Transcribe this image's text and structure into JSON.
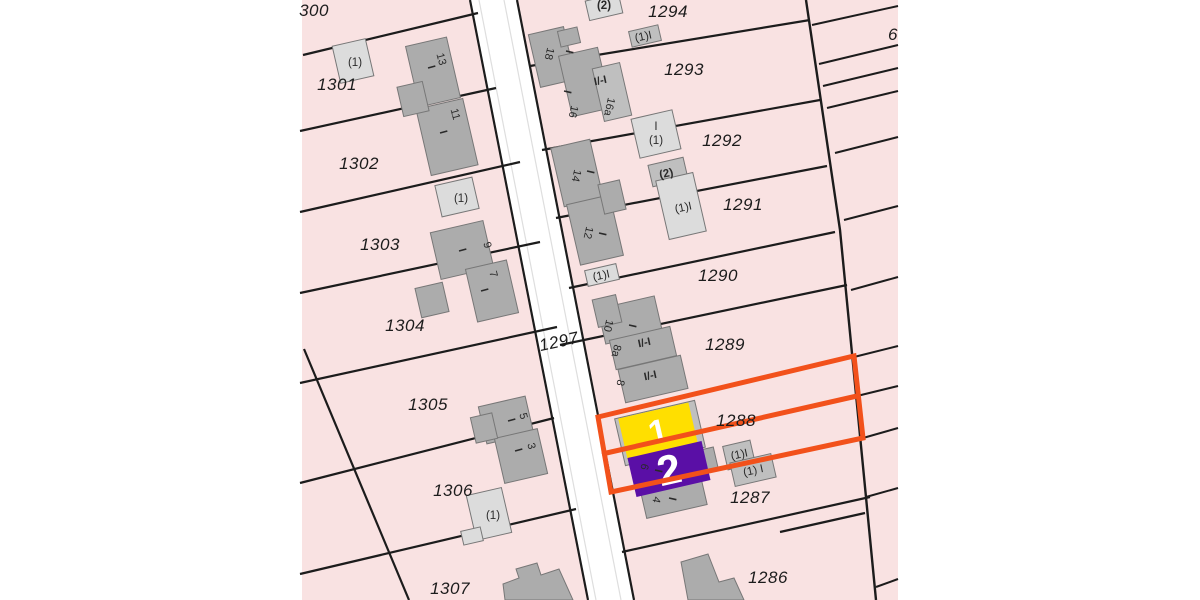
{
  "scene": {
    "type": "cadastral-parcel-map",
    "width": 1200,
    "height": 600
  },
  "colors": {
    "canvas_bg": "#ffffff",
    "parcel_fill": "#F9E2E2",
    "boundary_line": "#1c1c1c",
    "road_fill": "#ffffff",
    "road_inner_line": "#dedede",
    "building_dark": "#ACACAC",
    "building_mid": "#BFBFBF",
    "building_light": "#DCDCDC",
    "building_stroke": "#777777",
    "highlight_orange": "#F2511B",
    "selection_yellow": "#FFDF00",
    "selection_purple": "#5A0FA6",
    "label_color": "#1c1c1c",
    "small_label_color": "#2a2a2a",
    "selection_label_color": "#ffffff"
  },
  "map_area": {
    "x": 302,
    "y": 0,
    "w": 596,
    "h": 600
  },
  "road": {
    "polygon": "470,0 517,0 634,600 588,600",
    "left_edge": [
      470,
      0,
      588,
      600
    ],
    "right_edge": [
      517,
      0,
      634,
      600
    ],
    "inner_lines": [
      [
        479,
        0,
        596,
        600
      ],
      [
        504,
        0,
        621,
        600
      ]
    ]
  },
  "boundaries": [
    [
      303,
      55,
      478,
      13
    ],
    [
      300,
      131,
      496,
      88
    ],
    [
      300,
      212,
      520,
      162
    ],
    [
      300,
      293,
      540,
      242
    ],
    [
      300,
      383,
      557,
      327
    ],
    [
      300,
      483,
      554,
      418
    ],
    [
      300,
      574,
      576,
      509
    ],
    [
      304,
      349,
      409,
      600
    ],
    [
      530,
      66,
      810,
      20
    ],
    [
      542,
      150,
      820,
      100
    ],
    [
      556,
      218,
      827,
      166
    ],
    [
      569,
      288,
      835,
      232
    ],
    [
      560,
      345,
      847,
      285
    ],
    [
      597,
      417,
      854,
      356
    ],
    [
      602,
      454,
      857,
      396
    ],
    [
      611,
      492,
      863,
      438
    ],
    [
      622,
      552,
      870,
      497
    ],
    [
      780,
      532,
      865,
      513
    ]
  ],
  "spine": "806,0 840,230 876,600",
  "strip_lines": [
    [
      812,
      25,
      898,
      6
    ],
    [
      819,
      64,
      898,
      45
    ],
    [
      823,
      86,
      898,
      68
    ],
    [
      827,
      108,
      898,
      91
    ],
    [
      835,
      153,
      898,
      137
    ],
    [
      844,
      220,
      898,
      206
    ],
    [
      851,
      290,
      898,
      277
    ],
    [
      854,
      357,
      898,
      346
    ],
    [
      857,
      396,
      898,
      386
    ],
    [
      863,
      438,
      898,
      428
    ],
    [
      866,
      497,
      898,
      488
    ],
    [
      876,
      587,
      898,
      579
    ]
  ],
  "buildings": {
    "rects": [
      {
        "cx": 433,
        "cy": 72,
        "w": 42,
        "h": 62,
        "rot": -13,
        "fill": "dark"
      },
      {
        "cx": 447,
        "cy": 137,
        "w": 48,
        "h": 68,
        "rot": -13,
        "fill": "dark"
      },
      {
        "cx": 413,
        "cy": 99,
        "w": 26,
        "h": 30,
        "rot": -13,
        "fill": "dark"
      },
      {
        "cx": 353,
        "cy": 61,
        "w": 34,
        "h": 38,
        "rot": -13,
        "fill": "light"
      },
      {
        "cx": 462,
        "cy": 250,
        "w": 54,
        "h": 48,
        "rot": -13,
        "fill": "dark"
      },
      {
        "cx": 492,
        "cy": 291,
        "w": 42,
        "h": 54,
        "rot": -13,
        "fill": "dark"
      },
      {
        "cx": 432,
        "cy": 300,
        "w": 28,
        "h": 30,
        "rot": -13,
        "fill": "dark"
      },
      {
        "cx": 457,
        "cy": 197,
        "w": 38,
        "h": 32,
        "rot": -13,
        "fill": "light"
      },
      {
        "cx": 506,
        "cy": 420,
        "w": 48,
        "h": 38,
        "rot": -13,
        "fill": "dark"
      },
      {
        "cx": 521,
        "cy": 456,
        "w": 44,
        "h": 46,
        "rot": -13,
        "fill": "dark"
      },
      {
        "cx": 484,
        "cy": 428,
        "w": 22,
        "h": 26,
        "rot": -13,
        "fill": "dark"
      },
      {
        "cx": 489,
        "cy": 514,
        "w": 36,
        "h": 46,
        "rot": -13,
        "fill": "light"
      },
      {
        "cx": 472,
        "cy": 536,
        "w": 20,
        "h": 14,
        "rot": -13,
        "fill": "light"
      },
      {
        "cx": 552,
        "cy": 57,
        "w": 36,
        "h": 54,
        "rot": -13,
        "fill": "dark"
      },
      {
        "cx": 585,
        "cy": 82,
        "w": 40,
        "h": 62,
        "rot": -13,
        "fill": "dark"
      },
      {
        "cx": 612,
        "cy": 92,
        "w": 28,
        "h": 54,
        "rot": -13,
        "fill": "mid"
      },
      {
        "cx": 569,
        "cy": 37,
        "w": 20,
        "h": 16,
        "rot": -13,
        "fill": "dark"
      },
      {
        "cx": 645,
        "cy": 36,
        "w": 30,
        "h": 16,
        "rot": -13,
        "fill": "mid"
      },
      {
        "cx": 604,
        "cy": 7,
        "w": 34,
        "h": 20,
        "rot": -13,
        "fill": "light"
      },
      {
        "cx": 577,
        "cy": 173,
        "w": 40,
        "h": 60,
        "rot": -13,
        "fill": "dark"
      },
      {
        "cx": 595,
        "cy": 230,
        "w": 44,
        "h": 62,
        "rot": -13,
        "fill": "dark"
      },
      {
        "cx": 612,
        "cy": 197,
        "w": 22,
        "h": 30,
        "rot": -13,
        "fill": "dark"
      },
      {
        "cx": 668,
        "cy": 172,
        "w": 36,
        "h": 22,
        "rot": -13,
        "fill": "mid"
      },
      {
        "cx": 681,
        "cy": 206,
        "w": 38,
        "h": 60,
        "rot": -13,
        "fill": "light"
      },
      {
        "cx": 656,
        "cy": 134,
        "w": 42,
        "h": 40,
        "rot": -13,
        "fill": "light"
      },
      {
        "cx": 602,
        "cy": 275,
        "w": 32,
        "h": 16,
        "rot": -13,
        "fill": "light"
      },
      {
        "cx": 630,
        "cy": 320,
        "w": 58,
        "h": 36,
        "rot": -13,
        "fill": "dark"
      },
      {
        "cx": 643,
        "cy": 348,
        "w": 62,
        "h": 30,
        "rot": -13,
        "fill": "dark"
      },
      {
        "cx": 653,
        "cy": 379,
        "w": 64,
        "h": 34,
        "rot": -13,
        "fill": "dark"
      },
      {
        "cx": 607,
        "cy": 311,
        "w": 24,
        "h": 28,
        "rot": -13,
        "fill": "dark"
      },
      {
        "cx": 660,
        "cy": 433,
        "w": 82,
        "h": 48,
        "rot": -13,
        "fill": "mid"
      },
      {
        "cx": 672,
        "cy": 490,
        "w": 62,
        "h": 44,
        "rot": -13,
        "fill": "dark"
      },
      {
        "cx": 706,
        "cy": 460,
        "w": 20,
        "h": 22,
        "rot": -13,
        "fill": "dark"
      },
      {
        "cx": 739,
        "cy": 455,
        "w": 28,
        "h": 24,
        "rot": -13,
        "fill": "mid"
      },
      {
        "cx": 753,
        "cy": 470,
        "w": 42,
        "h": 24,
        "rot": -13,
        "fill": "mid"
      }
    ],
    "polys": [
      {
        "points": "503,584 519,578 516,569 537,563 541,575 559,569 573,600 505,600",
        "fill": "dark"
      },
      {
        "points": "681,562 708,554 719,582 734,578 744,600 688,600",
        "fill": "dark"
      }
    ]
  },
  "highlight": {
    "outline": "598,417 854,356 863,438 611,492",
    "divider": [
      602,
      454,
      857,
      396
    ],
    "stroke_width": 5
  },
  "selection": [
    {
      "label": "1",
      "cx": 658,
      "cy": 431,
      "w": 72,
      "h": 42,
      "rot": -13,
      "color": "#FFDF00",
      "font": 34
    },
    {
      "label": "2",
      "cx": 669,
      "cy": 469,
      "w": 76,
      "h": 40,
      "rot": -13,
      "color": "#5A0FA6",
      "font": 42
    }
  ],
  "labels": {
    "parcels": [
      {
        "text": "300",
        "x": 314,
        "y": 16
      },
      {
        "text": "1301",
        "x": 337,
        "y": 90
      },
      {
        "text": "1302",
        "x": 359,
        "y": 169
      },
      {
        "text": "1303",
        "x": 380,
        "y": 250
      },
      {
        "text": "1304",
        "x": 405,
        "y": 331
      },
      {
        "text": "1305",
        "x": 428,
        "y": 410
      },
      {
        "text": "1306",
        "x": 453,
        "y": 496
      },
      {
        "text": "1307",
        "x": 450,
        "y": 594
      },
      {
        "text": "1297",
        "x": 560,
        "y": 347,
        "rot": -12
      },
      {
        "text": "1294",
        "x": 668,
        "y": 17
      },
      {
        "text": "1293",
        "x": 684,
        "y": 75
      },
      {
        "text": "1292",
        "x": 722,
        "y": 146
      },
      {
        "text": "1291",
        "x": 743,
        "y": 210
      },
      {
        "text": "1290",
        "x": 718,
        "y": 281
      },
      {
        "text": "1289",
        "x": 725,
        "y": 350
      },
      {
        "text": "1288",
        "x": 736,
        "y": 426
      },
      {
        "text": "1287",
        "x": 750,
        "y": 503
      },
      {
        "text": "1286",
        "x": 768,
        "y": 583
      },
      {
        "text": "6",
        "x": 893,
        "y": 40
      }
    ],
    "house_numbers": [
      {
        "text": "13",
        "x": 438,
        "y": 60,
        "rot": 75
      },
      {
        "text": "11",
        "x": 452,
        "y": 115,
        "rot": 75
      },
      {
        "text": "9",
        "x": 484,
        "y": 246,
        "rot": 75
      },
      {
        "text": "7",
        "x": 490,
        "y": 275,
        "rot": 75
      },
      {
        "text": "5",
        "x": 520,
        "y": 417,
        "rot": 75
      },
      {
        "text": "3",
        "x": 528,
        "y": 447,
        "rot": 75
      },
      {
        "text": "18",
        "x": 546,
        "y": 53,
        "rot": 103
      },
      {
        "text": "16",
        "x": 570,
        "y": 111,
        "rot": 103
      },
      {
        "text": "16a",
        "x": 606,
        "y": 106,
        "rot": 103
      },
      {
        "text": "14",
        "x": 573,
        "y": 175,
        "rot": 103
      },
      {
        "text": "12",
        "x": 585,
        "y": 232,
        "rot": 103
      },
      {
        "text": "10",
        "x": 605,
        "y": 325,
        "rot": 103
      },
      {
        "text": "8a",
        "x": 613,
        "y": 350,
        "rot": 103
      },
      {
        "text": "8",
        "x": 617,
        "y": 382,
        "rot": 103
      },
      {
        "text": "6",
        "x": 641,
        "y": 466,
        "rot": 103
      },
      {
        "text": "4",
        "x": 653,
        "y": 499,
        "rot": 103
      }
    ],
    "storeys": [
      {
        "text": "I",
        "x": 428,
        "y": 68,
        "rot": 75
      },
      {
        "text": "I",
        "x": 440,
        "y": 133,
        "rot": 75
      },
      {
        "text": "I",
        "x": 459,
        "y": 251,
        "rot": 75
      },
      {
        "text": "I",
        "x": 481,
        "y": 291,
        "rot": 75
      },
      {
        "text": "I",
        "x": 508,
        "y": 421,
        "rot": 75
      },
      {
        "text": "I",
        "x": 515,
        "y": 451,
        "rot": 75
      },
      {
        "text": "I",
        "x": 566,
        "y": 51,
        "rot": 103
      },
      {
        "text": "I",
        "x": 564,
        "y": 91,
        "rot": 103
      },
      {
        "text": "I",
        "x": 587,
        "y": 171,
        "rot": 103
      },
      {
        "text": "I",
        "x": 599,
        "y": 233,
        "rot": 103
      },
      {
        "text": "I",
        "x": 629,
        "y": 325,
        "rot": 103
      },
      {
        "text": "I",
        "x": 655,
        "y": 470,
        "rot": 103
      },
      {
        "text": "I",
        "x": 669,
        "y": 498,
        "rot": 103
      },
      {
        "text": "I/-I",
        "x": 601,
        "y": 84,
        "rot": -12
      },
      {
        "text": "I/-I",
        "x": 645,
        "y": 346,
        "rot": -12
      },
      {
        "text": "I/-I",
        "x": 651,
        "y": 379,
        "rot": -12
      }
    ],
    "annex": [
      {
        "text": "(1)",
        "x": 355,
        "y": 66,
        "bold": false
      },
      {
        "text": "(1)",
        "x": 461,
        "y": 202,
        "bold": false
      },
      {
        "text": "(1)",
        "x": 493,
        "y": 519,
        "bold": false
      },
      {
        "text": "I",
        "x": 656,
        "y": 130,
        "bold": false
      },
      {
        "text": "(1)",
        "x": 656,
        "y": 144,
        "bold": false
      },
      {
        "text": "(1)I",
        "x": 684,
        "y": 211,
        "rot": -12,
        "bold": false
      },
      {
        "text": "(1)I",
        "x": 644,
        "y": 40,
        "rot": -12,
        "bold": false
      },
      {
        "text": "(2)",
        "x": 604,
        "y": 9,
        "bold": true
      },
      {
        "text": "(1)I",
        "x": 602,
        "y": 279,
        "rot": -12,
        "bold": false
      },
      {
        "text": "(2)",
        "x": 667,
        "y": 177,
        "rot": -12,
        "bold": true
      },
      {
        "text": "(1)I",
        "x": 740,
        "y": 458,
        "rot": -12,
        "bold": false
      },
      {
        "text": "(1) I",
        "x": 754,
        "y": 474,
        "rot": -12,
        "bold": false
      }
    ]
  }
}
